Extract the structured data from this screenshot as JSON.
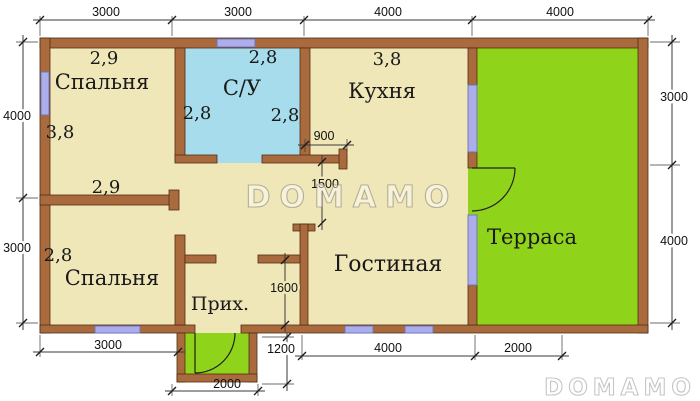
{
  "watermark": {
    "text": "DOMAMO"
  },
  "colors": {
    "wall": "#A96A3E",
    "floor": "#F0E7B9",
    "bathroom": "#A6DCEB",
    "terrace": "#8FD41A",
    "window": "#ABAEEB"
  },
  "rooms": {
    "bedroom1": {
      "name": "Спальня",
      "dim_top": "2,9",
      "dim_left": "3,8"
    },
    "bedroom2": {
      "name": "Спальня",
      "dim_top": "2,9",
      "dim_left": "2,8"
    },
    "bathroom": {
      "name": "С/У",
      "dim_top": "2,8",
      "dim_left": "2,8",
      "dim_right": "2,8"
    },
    "kitchen": {
      "name": "Кухня",
      "dim_top": "3,8"
    },
    "living": {
      "name": "Гостиная"
    },
    "terrace": {
      "name": "Терраса"
    },
    "hall": {
      "name": "Прих."
    }
  },
  "dimensions": {
    "top": [
      "3000",
      "3000",
      "4000",
      "4000"
    ],
    "left": [
      "4000",
      "3000"
    ],
    "right": [
      "3000",
      "4000"
    ],
    "bottom": [
      "3000",
      "4000",
      "2000"
    ],
    "porch": {
      "width": "2000",
      "depth": "1200"
    },
    "openings": {
      "kitchen": "900",
      "living": "1500",
      "hall": "1600"
    }
  }
}
